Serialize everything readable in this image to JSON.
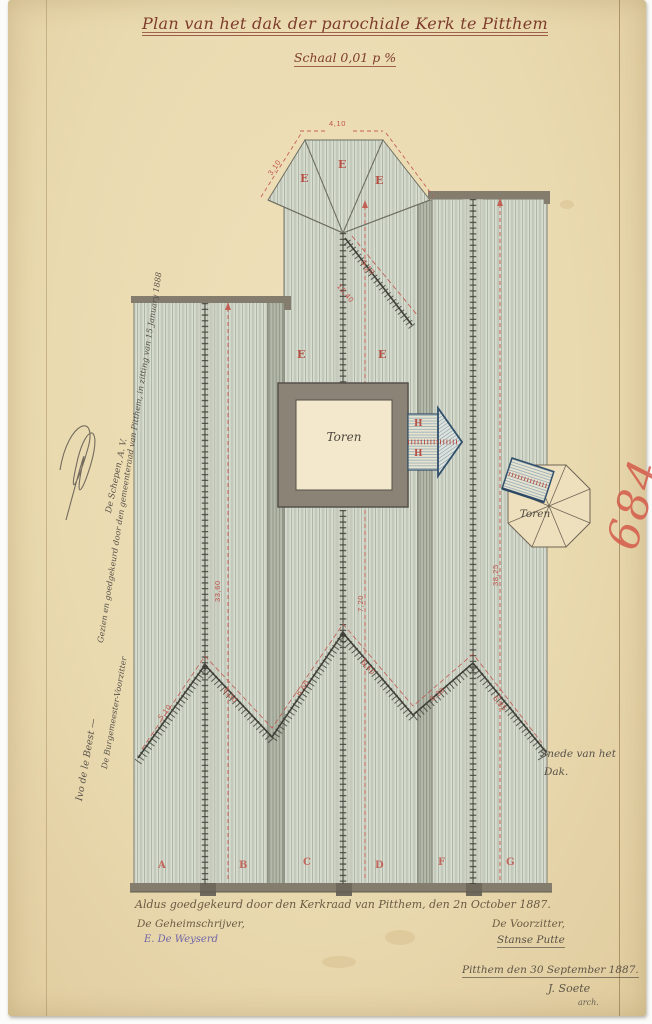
{
  "document": {
    "title": "Plan van het dak der parochiale Kerk te Pitthem",
    "scale_note": "Schaal 0,01 p %",
    "archive_number": "684"
  },
  "plan": {
    "tower_label": "Toren",
    "side_tower_label": "Toren",
    "section_note": {
      "line1": "Snede van het",
      "line2": "Dak."
    },
    "apse_letters": [
      "E",
      "E",
      "E"
    ],
    "nave_letters": [
      "E",
      "E"
    ],
    "dormer_letters": [
      "H",
      "H"
    ],
    "bay_letters": [
      "A",
      "B",
      "C",
      "D",
      "F",
      "G"
    ],
    "dimensions": {
      "apse_top": "4,10",
      "apse_slope": "3,10",
      "valley_upper": "6,10",
      "valley_lower": "10,40",
      "left_ridge": "33,60",
      "center_ridge": "7,20",
      "right_ridge": "38,25",
      "w_arm_1": "5,10",
      "w_arm_2": "6,30",
      "w_arm_3": "6,60",
      "w_arm_4": "6,60",
      "w_arm_5": "6,30",
      "w_arm_6": "6,35"
    }
  },
  "margin_note": {
    "line1": "Gezien en goedgekeurd door den gemeenteraad van Pitthem, in zitting van 15 January 1888",
    "line2": "De Schepen, A. V.",
    "line3": "De Burgemeester-Voorzitter",
    "line4": "Ivo de le Beest —"
  },
  "approval": {
    "statement": "Aldus goedgekeurd door den Kerkraad van Pitthem, den 2n October 1887.",
    "secretary_title": "De Geheimschrijver,",
    "secretary_signature": "E. De Weyserd",
    "chairman_title": "De Voorzitter,",
    "chairman_signature": "Stanse Putte"
  },
  "colophon": {
    "place_date": "Pitthem den 30 September 1887.",
    "signature": "J. Soete",
    "role": "arch."
  },
  "colors": {
    "paper": "#eadbb2",
    "roof_wash": "#d9ded1",
    "ink_red": "#b5443a",
    "ink_sepia": "#6b5a43",
    "ink_purple": "#6f64a8",
    "crayon_red": "#d4574a",
    "tower_grey": "#8a8376",
    "slate_blue": "#7f9cab"
  }
}
